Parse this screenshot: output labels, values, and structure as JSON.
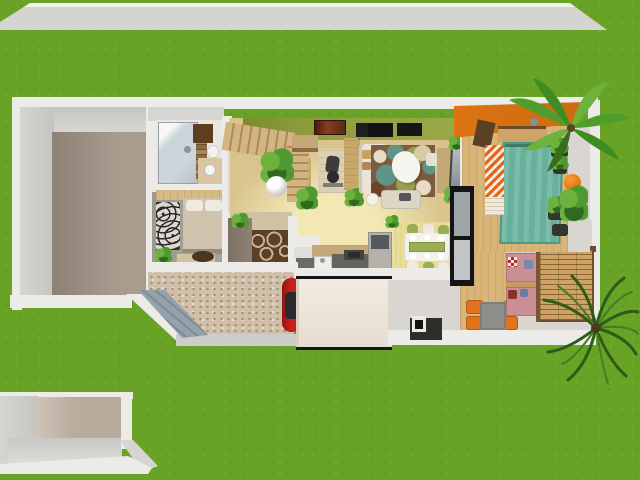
{
  "scene": {
    "type": "3d-floor-plan-render",
    "view": "top-down-aerial",
    "palette": {
      "grass": "#69a326",
      "road": "#d5d4d0",
      "road_edge": "#f2f1ed",
      "wall": "#edebe7",
      "wall_face": "#d7d5d1",
      "wall_face_dark": "#c6c4c0",
      "floor_wood_gray": "#a89c8f",
      "floor_wood_gray_dark": "#8c8175",
      "floor_basement": "#b8ac9f",
      "living_floor": "#d8c48c",
      "living_floor_bright": "#f3e7b4",
      "hall_floor": "#cfc2a2",
      "green_wall": "#8e9c3c",
      "stairs_wood": "#d2b582",
      "deck_wood": "#d9b678",
      "terrace_concrete": "#d9d6d1",
      "carpet_base": "#d0bfa9",
      "carpet_dot": "#a58f74",
      "ramp": "#95a1ab",
      "awning": "#f3eae1",
      "orange_roof": "#dd7513",
      "teal_rug": "#66b09c",
      "teal_rug_dark": "#4e9886",
      "chevron_orange": "#e4661c",
      "chevron_white": "#f6ede0",
      "car_red": "#c6201e",
      "sofa_cream": "#eae4d6",
      "chaise": "#dcd6c6",
      "rug_brown": "#7c5b40",
      "rug_ring": "#c9b292",
      "swirl_teal": "#5f9488",
      "swirl_olive": "#9aa050",
      "swirl_cream": "#e8ddc4",
      "pergola_wood": "#cda262",
      "pergola_beam": "#6d4d2c",
      "cushion_pink": "#c98f94",
      "orange_chair": "#e0731c",
      "table_gray": "#8e8e8a",
      "fireplace_dark": "#2e2e2a",
      "counter_dark": "#6a6a66",
      "counter_tan": "#c4a878",
      "cabinet_white": "#eceae4",
      "fridge_gray": "#b6b2aa",
      "dining_rug": "#e7d98f",
      "table_white": "#f3f1e9",
      "chair_olive": "#9aae56",
      "bed_blanket": "#d0c3ad",
      "pillow_white": "#efeae0",
      "wardrobe_pattern": "#dcd8d0",
      "dresser": "#d2c2a4",
      "cabinet_taupe": "#8d8174",
      "closet_white": "#e7e5e0",
      "closet_wood": "#d9c08c",
      "plant_green": "#4e9a30",
      "plant_dark": "#2f6a1f",
      "plant_light": "#6cb23c",
      "lavender": "#8f7fae",
      "terracotta": "#b5673a",
      "glass": "#ccd6da",
      "mosaic": "#8a6a42",
      "vanity": "#d8c6a2",
      "shelf_brown": "#5d3f20",
      "tv_gray": "#9aa2a8",
      "door_black": "#141416",
      "ball_orange": "#e8790e",
      "bench_wood": "#cca465",
      "bedroom_floor": "#a6a59a",
      "bedroom_wall_wood": "#d6b984"
    },
    "environment": [
      {
        "id": "grass-lawn",
        "label": "grass lawn"
      },
      {
        "id": "street",
        "label": "street strip"
      },
      {
        "id": "basement-garage",
        "label": "lower garage room below street"
      },
      {
        "id": "entry-ramp",
        "label": "gray entry ramp"
      },
      {
        "id": "driveway-carpet",
        "label": "speckled driveway court"
      }
    ],
    "rooms": [
      {
        "id": "empty-room-west",
        "label": "empty room with gray wood floor"
      },
      {
        "id": "bathroom",
        "label": "bathroom with glass shower"
      },
      {
        "id": "bedroom",
        "label": "bedroom with double bed"
      },
      {
        "id": "hallway",
        "label": "entry hallway with circle rug"
      },
      {
        "id": "living-room",
        "label": "living room with green wall"
      },
      {
        "id": "kitchen",
        "label": "kitchen along south wall"
      },
      {
        "id": "dining-area",
        "label": "dining area with table set"
      },
      {
        "id": "terrace",
        "label": "wooden deck terrace with orange roof"
      },
      {
        "id": "patio",
        "label": "patio with pergola lounge"
      }
    ],
    "furniture": [
      {
        "id": "staircase",
        "label": "wooden staircase"
      },
      {
        "id": "exercise-bike",
        "label": "exercise bike on mat"
      },
      {
        "id": "corner-sofa",
        "label": "cream corner sofa"
      },
      {
        "id": "swirl-area-rug",
        "label": "multicolor swirl rug"
      },
      {
        "id": "coffee-table",
        "label": "white oval coffee table"
      },
      {
        "id": "tv-set",
        "label": "TV on wooden stand"
      },
      {
        "id": "dining-table-set",
        "label": "dining table with six chairs"
      },
      {
        "id": "kitchen-counters",
        "label": "kitchen counters and sink"
      },
      {
        "id": "fridge",
        "label": "refrigerator"
      },
      {
        "id": "double-bed",
        "label": "double bed"
      },
      {
        "id": "patterned-wardrobe",
        "label": "patterned wardrobe"
      },
      {
        "id": "dresser",
        "label": "dresser"
      },
      {
        "id": "shower",
        "label": "glass shower"
      },
      {
        "id": "vanity",
        "label": "bathroom vanity"
      },
      {
        "id": "red-car",
        "label": "red car under carport"
      },
      {
        "id": "carport-awning",
        "label": "carport awning"
      },
      {
        "id": "pergola",
        "label": "slatted wood pergola"
      },
      {
        "id": "outdoor-lounge",
        "label": "pink outdoor lounge cushions"
      },
      {
        "id": "patio-table-chairs",
        "label": "gray table with orange chairs"
      },
      {
        "id": "outdoor-fireplace",
        "label": "outdoor fireplace"
      },
      {
        "id": "teal-deck-rug",
        "label": "teal striped deck rug"
      },
      {
        "id": "chevron-lounger",
        "label": "orange chevron lounger mat"
      },
      {
        "id": "deck-bench",
        "label": "deck bench"
      },
      {
        "id": "orange-ball",
        "label": "orange exercise ball"
      },
      {
        "id": "palm-tree-north",
        "label": "palm tree (north-east)"
      },
      {
        "id": "palm-tree-south",
        "label": "palm tree (south-east)"
      }
    ]
  }
}
